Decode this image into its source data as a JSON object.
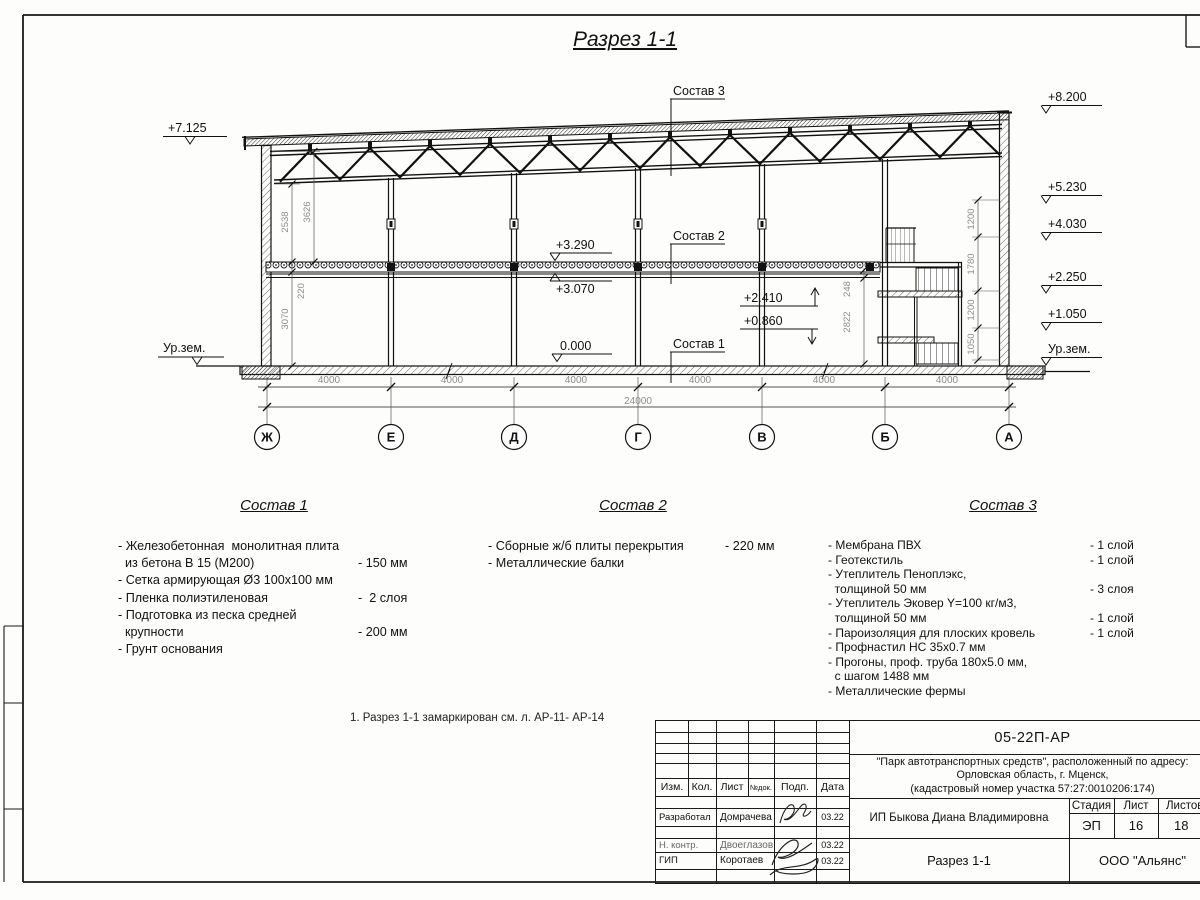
{
  "sheet": {
    "title": "Разрез 1-1",
    "note": "1. Разрез 1-1 замаркирован см. л. АР-11- АР-14"
  },
  "drawing": {
    "elev_left": [
      "+7.125",
      "Ур.зем."
    ],
    "elev_right": [
      "+8.200",
      "+5.230",
      "+4.030",
      "+2.250",
      "+1.050",
      "Ур.зем."
    ],
    "elev_slab_top": "+3.290",
    "elev_slab_bot": "+3.070",
    "elev_zero": "0.000",
    "elev_stair_up": "+2.410",
    "elev_stair_low": "+0.860",
    "leaders": [
      "Состав 3",
      "Состав 2",
      "Состав 1"
    ],
    "dims_left": [
      "2538",
      "3626",
      "220",
      "3070"
    ],
    "dims_right": [
      "1200",
      "1780",
      "1200",
      "1050"
    ],
    "dims_stair": [
      "248",
      "2822"
    ],
    "axes": [
      "Ж",
      "Е",
      "Д",
      "Г",
      "В",
      "Б",
      "А"
    ],
    "spans": [
      "4000",
      "4000",
      "4000",
      "4000",
      "4000",
      "4000"
    ],
    "total": "24000"
  },
  "comp1": {
    "title": "Состав 1",
    "rows": [
      {
        "t": "- Железобетонная  монолитная плита",
        "v": ""
      },
      {
        "t": "  из бетона В 15 (М200)",
        "v": "- 150 мм"
      },
      {
        "t": "- Сетка армирующая Ø3 100x100 мм",
        "v": ""
      },
      {
        "t": "- Пленка полиэтиленовая",
        "v": "-  2 слоя"
      },
      {
        "t": "- Подготовка из песка средней",
        "v": ""
      },
      {
        "t": "  крупности",
        "v": "- 200 мм"
      },
      {
        "t": "- Грунт основания",
        "v": ""
      }
    ]
  },
  "comp2": {
    "title": "Состав 2",
    "rows": [
      {
        "t": "- Сборные ж/б плиты перекрытия",
        "v": "- 220 мм"
      },
      {
        "t": "- Металлические балки",
        "v": ""
      }
    ]
  },
  "comp3": {
    "title": "Состав 3",
    "rows": [
      {
        "t": "- Мембрана ПВХ",
        "v": "- 1 слой"
      },
      {
        "t": "- Геотекстиль",
        "v": "- 1 слой"
      },
      {
        "t": "- Утеплитель Пеноплэкс,",
        "v": ""
      },
      {
        "t": "  толщиной 50 мм",
        "v": "- 3 слоя"
      },
      {
        "t": "- Утеплитель Эковер Y=100 кг/м3,",
        "v": ""
      },
      {
        "t": "  толщиной 50 мм",
        "v": "- 1 слой"
      },
      {
        "t": "- Пароизоляция для плоских кровель",
        "v": "- 1 слой"
      },
      {
        "t": "- Профнастил НС 35x0.7 мм",
        "v": ""
      },
      {
        "t": "- Прогоны, проф. труба 180x5.0 мм,",
        "v": ""
      },
      {
        "t": "  с шагом 1488 мм",
        "v": ""
      },
      {
        "t": "- Металлические фермы",
        "v": ""
      }
    ]
  },
  "titleblock": {
    "doc_code": "05-22П-АР",
    "project_line1": "\"Парк автотранспортных средств\",  расположенный по адресу:",
    "project_line2": "Орловская область, г. Мценск,",
    "project_line3": "(кадастровый номер участка 57:27:0010206:174)",
    "client": "ИП Быкова Диана Владимировна",
    "sheet_name": "Разрез 1-1",
    "company": "ООО \"Альянс\"",
    "col_izm": "Изм.",
    "col_kol": "Кол.",
    "col_list": "Лист",
    "col_ndok": "№док.",
    "col_podp": "Подп.",
    "col_data": "Дата",
    "stage_label": "Стадия",
    "sheet_label": "Лист",
    "sheets_label": "Листов",
    "stage": "ЭП",
    "sheet_no": "16",
    "sheets_total": "18",
    "rows": [
      {
        "role": "Разработал",
        "name": "Домрачева",
        "date": "03.22"
      },
      {
        "role": "Н. контр.",
        "name": "Двоеглазов",
        "date": "03.22"
      },
      {
        "role": "ГИП",
        "name": "Коротаев",
        "date": "03.22"
      }
    ]
  }
}
